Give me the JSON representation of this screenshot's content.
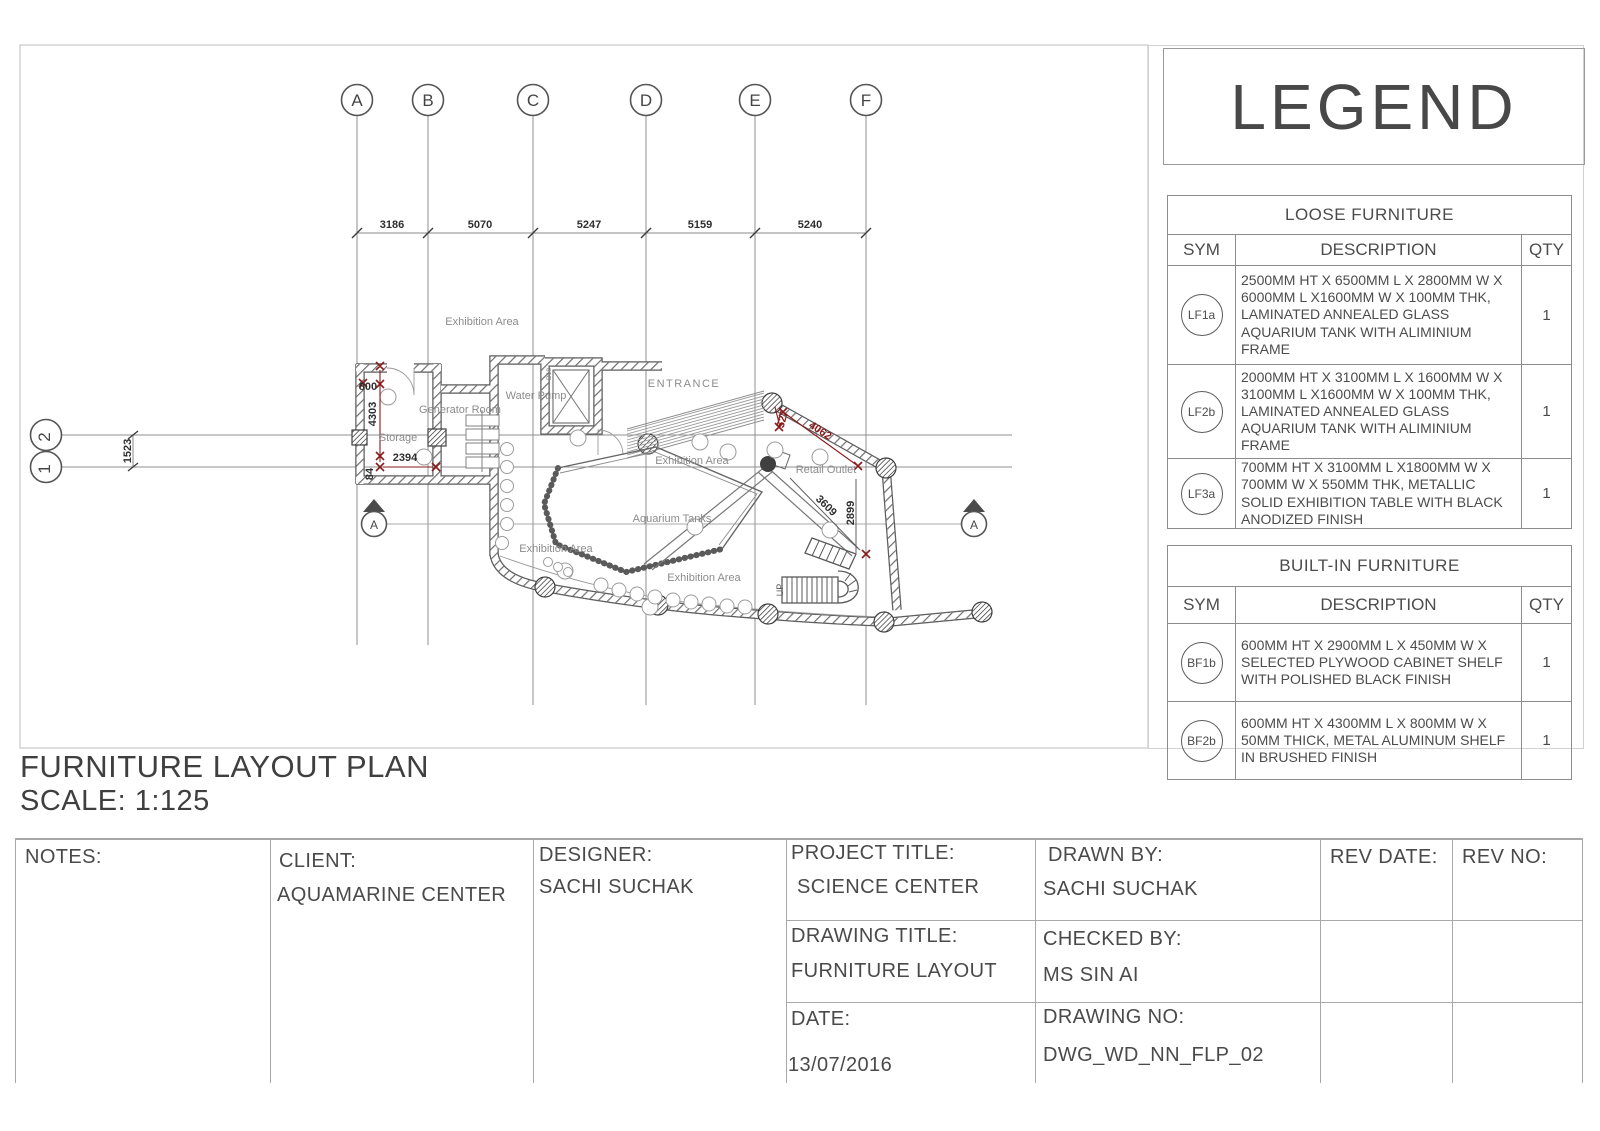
{
  "sheet": {
    "drawing_title": "FURNITURE LAYOUT PLAN",
    "drawing_scale": "SCALE: 1:125"
  },
  "legend": {
    "title": "LEGEND",
    "loose_furniture": {
      "title": "LOOSE FURNITURE",
      "headers": {
        "sym": "SYM",
        "description": "DESCRIPTION",
        "qty": "QTY"
      },
      "rows": [
        {
          "sym": "LF1a",
          "description": "2500MM HT X 6500MM L X 2800MM W X 6000MM L X1600MM W X 100MM THK, LAMINATED ANNEALED GLASS AQUARIUM TANK WITH ALIMINIUM FRAME",
          "qty": "1"
        },
        {
          "sym": "LF2b",
          "description": "2000MM HT X 3100MM L X 1600MM W X 3100MM L X1600MM W X 100MM THK, LAMINATED ANNEALED GLASS AQUARIUM TANK WITH ALIMINIUM FRAME",
          "qty": "1"
        },
        {
          "sym": "LF3a",
          "description": "700MM HT X 3100MM L X1800MM W X 700MM W X 550MM THK, METALLIC SOLID EXHIBITION TABLE WITH BLACK ANODIZED FINISH",
          "qty": "1"
        }
      ]
    },
    "built_in_furniture": {
      "title": "BUILT-IN FURNITURE",
      "headers": {
        "sym": "SYM",
        "description": "DESCRIPTION",
        "qty": "QTY"
      },
      "rows": [
        {
          "sym": "BF1b",
          "description": "600MM HT X 2900MM L X 450MM W X SELECTED PLYWOOD CABINET SHELF WITH POLISHED BLACK FINISH",
          "qty": "1"
        },
        {
          "sym": "BF2b",
          "description": "600MM HT X 4300MM L X 800MM W X 50MM THICK, METAL ALUMINUM SHELF IN BRUSHED FINISH",
          "qty": "1"
        }
      ]
    }
  },
  "plan": {
    "grid_columns": [
      "A",
      "B",
      "C",
      "D",
      "E",
      "F"
    ],
    "grid_rows": [
      "2",
      "1"
    ],
    "top_dimensions": [
      "3186",
      "5070",
      "5247",
      "5159",
      "5240"
    ],
    "dimensions": {
      "row_spacing": "1523",
      "storage_door": "800",
      "storage_depth": "4303",
      "storage_width": "2394",
      "wall_offset": "84",
      "entrance_edge": "527",
      "retail_wall": "4062",
      "walkway_run": "3609",
      "retail_depth": "2899"
    },
    "labels": {
      "exhibition_area": "Exhibition Area",
      "entrance": "ENTRANCE",
      "water_pump": "Water Pump",
      "generator_room": "Generator Room",
      "storage": "Storage",
      "retail_outlet": "Retail Outlet",
      "aquarium_tanks": "Aquarium Tanks",
      "up": "UP",
      "door_tag": "D18",
      "section_marker": "A"
    }
  },
  "titleblock": {
    "notes_label": "NOTES:",
    "client_label": "CLIENT:",
    "client": "AQUAMARINE CENTER",
    "designer_label": "DESIGNER:",
    "designer": "SACHI SUCHAK",
    "project_title_label": "PROJECT TITLE:",
    "project_title": "SCIENCE CENTER",
    "drawing_title_label": "DRAWING TITLE:",
    "drawing_title": "FURNITURE LAYOUT",
    "date_label": "DATE:",
    "date": "13/07/2016",
    "drawn_by_label": "DRAWN BY:",
    "drawn_by": "SACHI SUCHAK",
    "checked_by_label": "CHECKED BY:",
    "checked_by": "MS SIN AI",
    "drawing_no_label": "DRAWING NO:",
    "drawing_no": "DWG_WD_NN_FLP_02",
    "rev_date_label": "REV DATE:",
    "rev_no_label": "REV NO:"
  }
}
